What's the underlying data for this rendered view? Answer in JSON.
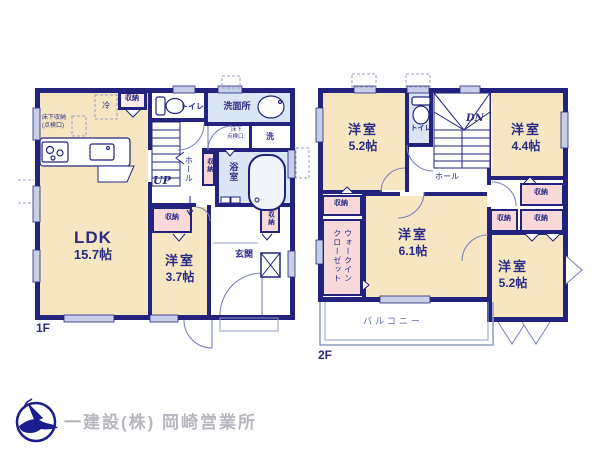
{
  "f1": {
    "label": "1F",
    "ldk_name": "LDK",
    "ldk_area": "15.7帖",
    "bed_name": "洋室",
    "bed_area": "3.7帖",
    "genkan": "玄関",
    "senmenjo": "洗面所",
    "toilet": "トイレ",
    "bath": "浴室",
    "up": "UP",
    "hall": "ホール",
    "fridge": "冷",
    "washer": "洗",
    "underfloor_1": "床下収納",
    "underfloor_2": "(点検口)",
    "hatch_1": "床下",
    "hatch_2": "点検口"
  },
  "f2": {
    "label": "2F",
    "bed_tl_name": "洋室",
    "bed_tl_area": "5.2帖",
    "bed_tr_name": "洋室",
    "bed_tr_area": "4.4帖",
    "bed_mid_name": "洋室",
    "bed_mid_area": "6.1帖",
    "bed_br_name": "洋室",
    "bed_br_area": "5.2帖",
    "toilet": "トイレ",
    "dn": "DN",
    "hall": "ホール",
    "wic": "ウォークインクローゼット",
    "balcony": "バルコニー"
  },
  "shared": {
    "closet": "収納"
  },
  "footer": {
    "company": "一建設(株) 岡崎営業所"
  },
  "colors": {
    "wall_navy": "#23237e",
    "room_cream": "#f6e6c2",
    "wet_blue": "#d9e7f5",
    "closet_pink": "#f7d9da",
    "window_gray": "#c7cee8",
    "thin_line_gray": "#8f9cc4",
    "label_navy": "#2b2b85",
    "footer_gray": "#b6b6bf",
    "logo_navy": "#1c1c8f"
  }
}
